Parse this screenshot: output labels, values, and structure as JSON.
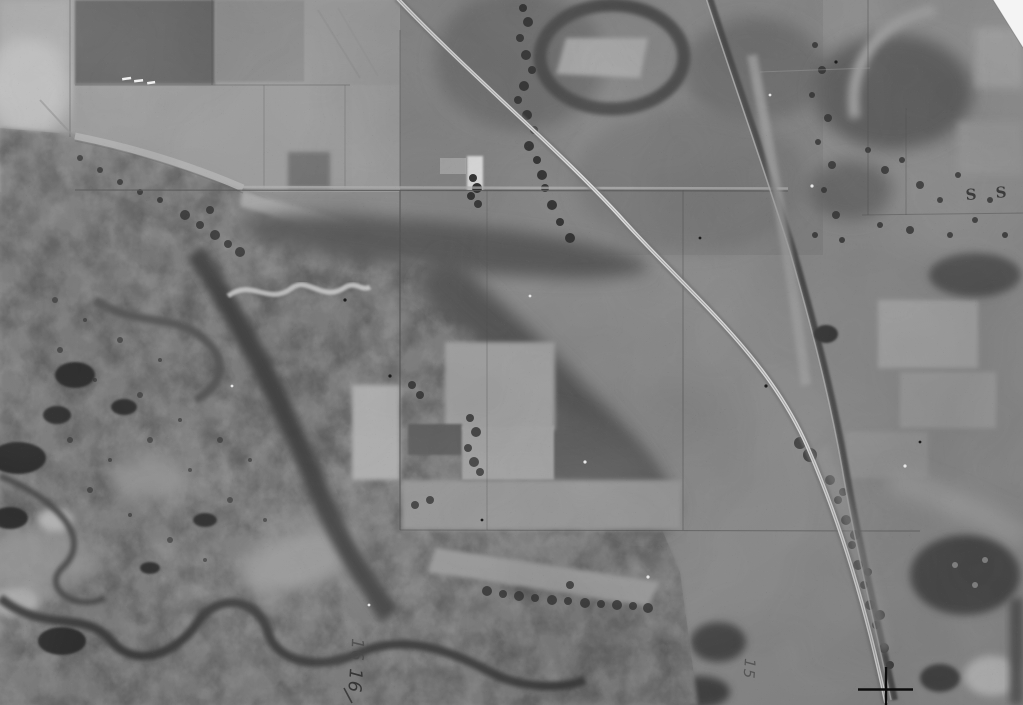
{
  "meta": {
    "alt": "Black-and-white historical aerial survey photograph of farmland and a river floodplain with a diagonal highway and railroad"
  },
  "annotations": {
    "section_number_upper": "16",
    "section_number_lower": "16",
    "section_number_east": "15",
    "margin_mark": "S S"
  },
  "palette": {
    "paper_white": "#f4f4f4",
    "highlight_road": "#dcdcdc",
    "light_field": "#a6a6a6",
    "midtone": "#8c8c8c",
    "floodplain": "#7e7e7e",
    "dark_vegetation": "#4a4a4a",
    "water_dark": "#2e2e2e",
    "pencil_ink": "#3a3a3a",
    "fiducial_ink": "#0d0d0d"
  }
}
